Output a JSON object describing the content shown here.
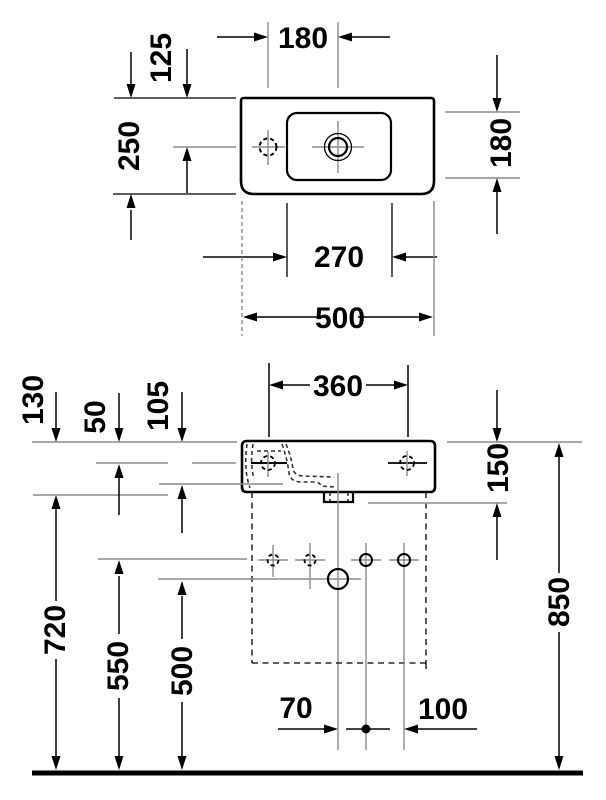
{
  "drawing": {
    "type": "washbasin technical dimension drawing",
    "units": "mm",
    "colors": {
      "line": "#000000",
      "extension_line": "#8c8c8c",
      "background": "#ffffff"
    },
    "top_view": {
      "tap_hole_to_drain": "180",
      "tap_hole_from_back": "125",
      "overall_depth": "250",
      "bowl_inner_depth": "180",
      "bowl_inner_width": "270",
      "overall_width": "500"
    },
    "front_view": {
      "body_height": "130",
      "fixing_holes_from_rim": "50",
      "bowl_inside_depth": "105",
      "fixing_hole_spacing": "360",
      "rim_to_outlet": "150",
      "rim_height_above_floor": "850",
      "underside_height": "720",
      "supply_height": "550",
      "waste_height": "500",
      "drain_offset_left": "70",
      "drain_offset_right": "100"
    }
  }
}
